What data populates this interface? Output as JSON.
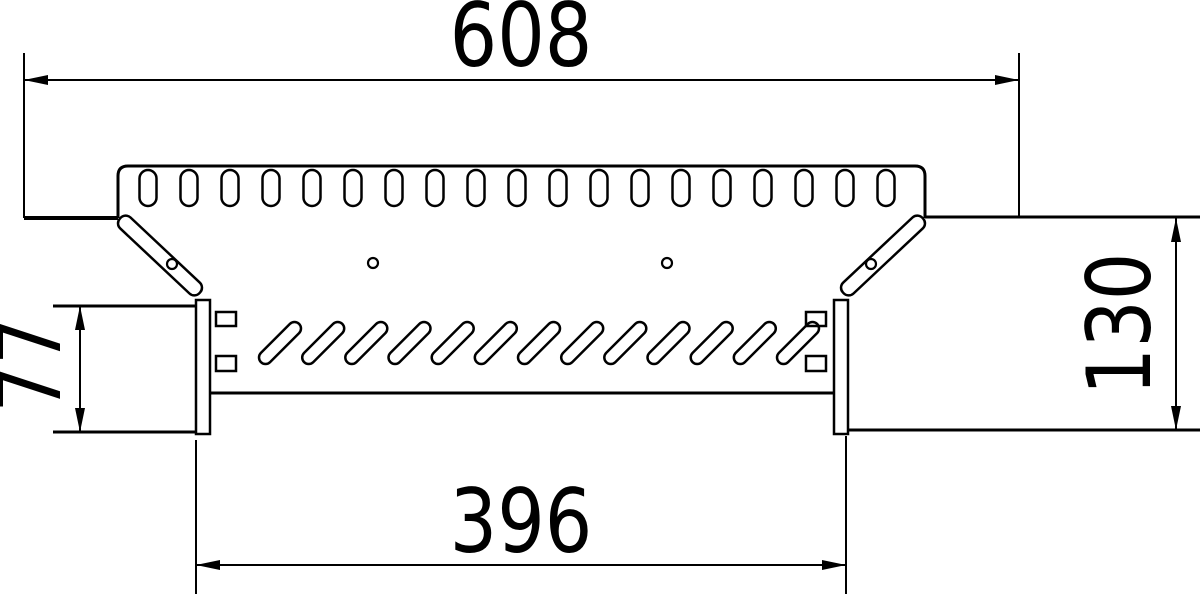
{
  "drawing": {
    "title": "add-on-tee-technical-drawing",
    "dimensions": {
      "top_width": "608",
      "bottom_width": "396",
      "right_height": "130",
      "left_height": "77"
    },
    "features": {
      "top_slot_count": 19,
      "top_slot_first_cx": 148,
      "top_slot_last_cx": 886,
      "diagonal_slot_count": 13,
      "diagonal_slot_first_cx": 280,
      "diagonal_slot_last_cx": 798
    },
    "colors": {
      "line": "#000000",
      "background": "#ffffff"
    }
  }
}
